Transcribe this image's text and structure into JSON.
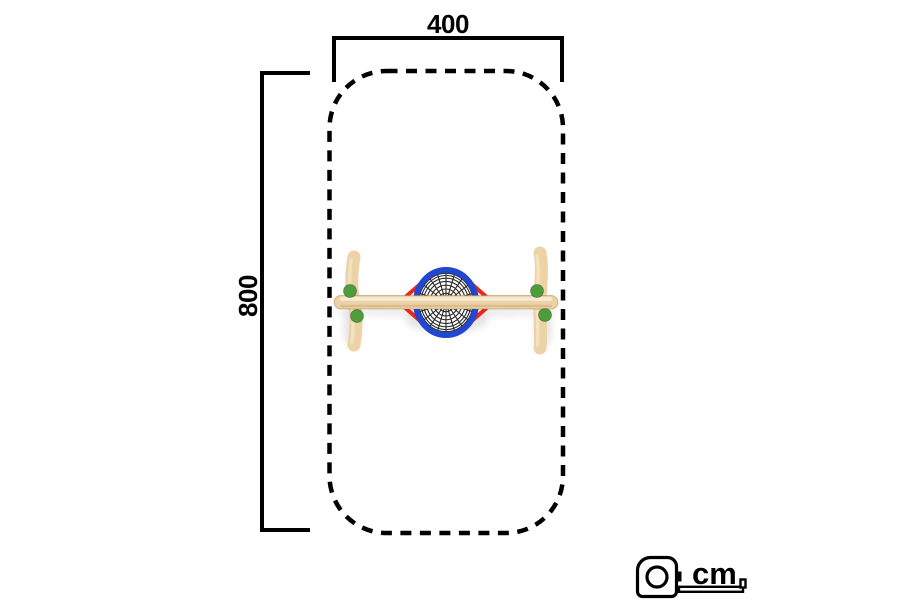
{
  "dimensions": {
    "width": {
      "label": "400",
      "value_cm": 400
    },
    "height": {
      "label": "800",
      "value_cm": 800
    }
  },
  "scale": {
    "unit_label": "cm",
    "icon": "tape-measure-icon"
  },
  "safety_zone": {
    "shape": "rounded-rectangle",
    "line_style": "dashed"
  },
  "equipment": {
    "name": "nest-swing-top-view",
    "parts": [
      "wood-beam",
      "wood-post-left",
      "wood-post-right",
      "green-post-caps",
      "blue-basket-ring",
      "rope-net",
      "red-suspension-ropes"
    ]
  },
  "colors": {
    "background": "#ffffff",
    "ink": "#000000",
    "wood": "#ecd2a6",
    "wood_light": "#f7e7c6",
    "wood_shade": "#d2ad79",
    "cap_green": "#4d9e3b",
    "ring_blue": "#2147d0",
    "rope_red": "#e8261b",
    "net": "#2a2a2a",
    "shadow": "#a8a8a8"
  }
}
